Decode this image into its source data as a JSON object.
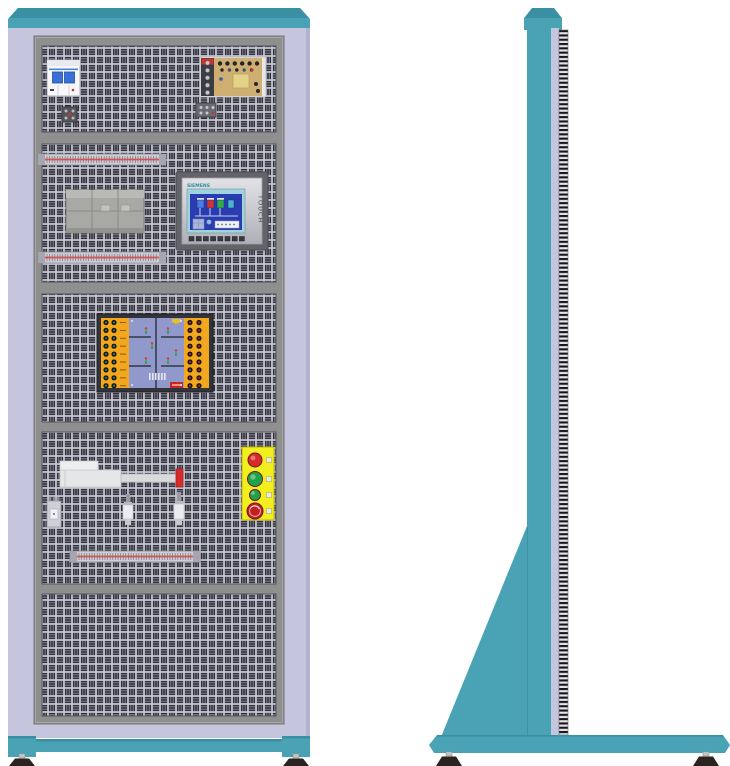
{
  "illustration": {
    "subject": "Electrical automation training cabinet",
    "views": [
      "front",
      "side"
    ]
  },
  "texts": {
    "hmi_brand": "SIEMENS",
    "hmi_touch": "TOUCH"
  },
  "hmi": {
    "function_keys": 8,
    "screen_color": "#2a3db0",
    "bezel_color": "#63636a"
  },
  "pushbuttons": {
    "panel_color": "#f2ee20",
    "items": [
      {
        "name": "red-pushbutton",
        "color": "#d42b2b",
        "r": 7,
        "cy": 460
      },
      {
        "name": "green-pushbutton",
        "color": "#1fa34a",
        "r": 7.5,
        "cy": 479
      },
      {
        "name": "green-pushbutton-small",
        "color": "#1fa34a",
        "r": 5.5,
        "cy": 495
      },
      {
        "name": "emergency-stop-button",
        "color": "#c12020",
        "r": 8,
        "cy": 511
      }
    ]
  },
  "traffic_board": {
    "strip_color": "#f2a71f",
    "field_color": "#9098cc",
    "label_color": "#c4281e",
    "left_sockets": {
      "rows": 9,
      "cols": [
        106,
        114
      ],
      "color": "#2f7a35"
    },
    "right_sockets": {
      "rows": 9,
      "cols": [
        190,
        199
      ],
      "color": "#9e2b23"
    }
  },
  "terminal_strips": {
    "count": 3,
    "line_color": "#d84848"
  },
  "colors": {
    "teal": "#4aa3b5",
    "teal_dark": "#3a8fa3",
    "lavender": "#c6c5de",
    "frame_gray": "#8f8f8f",
    "panel_bg": "#c9c9d8",
    "panel_slot": "#2f2f38",
    "cylinder_tip": "#d42b2b",
    "psu_board": "#cfae72",
    "plc_body": "#a8a8a4",
    "breaker_toggle": "#3a6fd8",
    "foot_dark": "#2b2320"
  }
}
